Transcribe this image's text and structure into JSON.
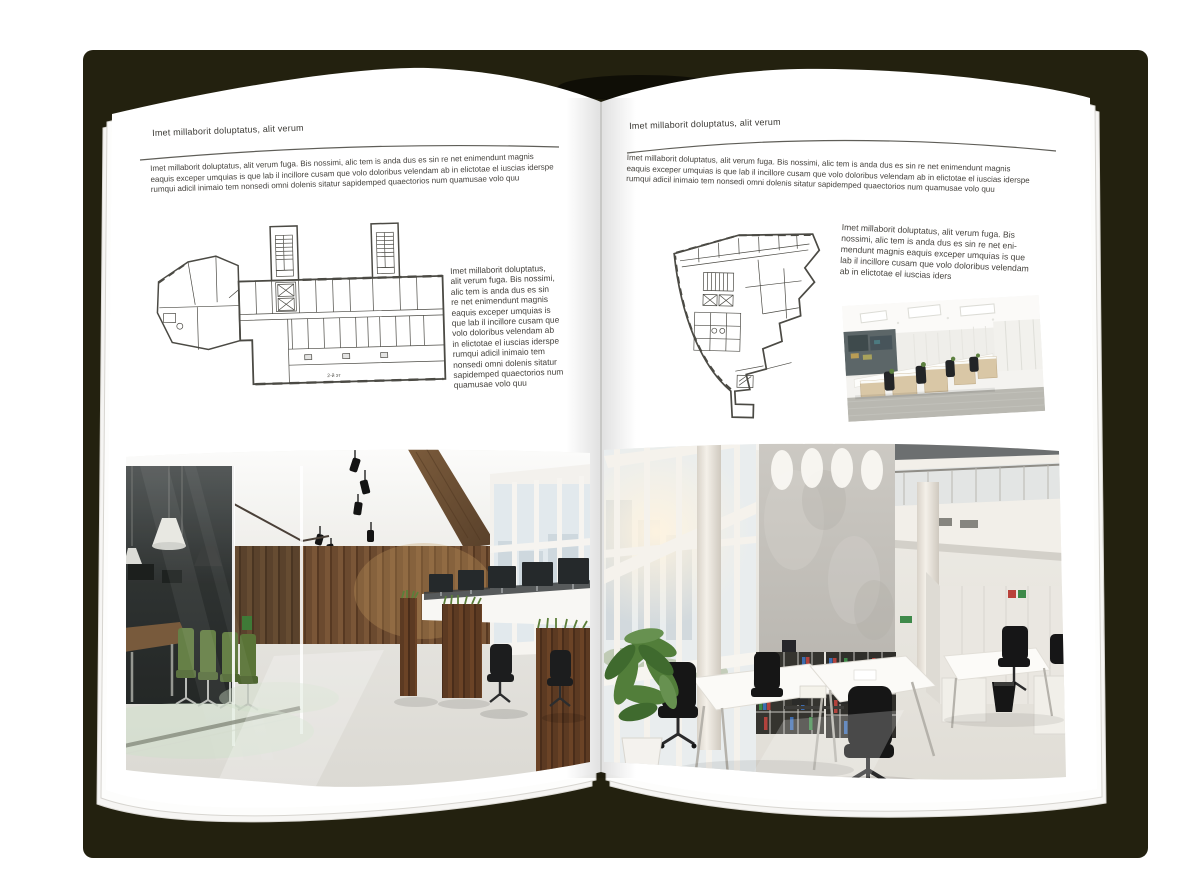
{
  "spread": {
    "left_page": {
      "header": "Imet millaborit doluptatus, alit verum",
      "intro_lines": [
        "Imet millaborit doluptatus, alit verum fuga. Bis nossimi, alic tem is anda dus es sin re net enimendunt magnis",
        "eaquis exceper umquias is que lab il incillore cusam que volo doloribus velendam ab in elictotae el iuscias iderspe",
        "rumqui adicil inimaio tem nonsedi omni dolenis sitatur sapidemped quaectorios num quamusae volo quu"
      ],
      "caption_lines": [
        "Imet millaborit doluptatus,",
        "alit verum fuga. Bis nossimi,",
        "alic tem is anda dus es sin",
        "re net enimendunt magnis",
        "eaquis exceper umquias is",
        "que lab il incillore cusam que",
        "volo doloribus velendam ab",
        "in elictotae el iuscias iderspe",
        "rumqui adicil inimaio tem",
        "nonsedi omni dolenis sitatur",
        "sapidemped quaectorios num",
        "quamusae volo quu"
      ],
      "plan_label": "2-й эт"
    },
    "right_page": {
      "header": "Imet millaborit doluptatus, alit verum",
      "intro_lines": [
        "Imet millaborit doluptatus, alit verum fuga. Bis nossimi, alic tem is anda dus es sin re net enimendunt magnis",
        "eaquis exceper umquias is que lab il incillore cusam que volo doloribus velendam ab in elictotae el iuscias iderspe",
        "rumqui adicil inimaio tem nonsedi omni dolenis sitatur sapidemped quaectorios num quamusae volo quu"
      ],
      "caption_lines": [
        "Imet millaborit doluptatus, alit verum fuga. Bis",
        "nossimi, alic tem is anda dus es sin re net eni-",
        "mendunt magnis eaquis exceper umquias is que",
        "lab il incillore cusam que volo doloribus velendam",
        "ab in elictotae el iuscias iders"
      ]
    }
  },
  "colors": {
    "cover": "#23210f",
    "page": "#ffffff",
    "text": "#45423d",
    "plan_line": "#4b4a44",
    "wood": "#7a5637",
    "chair_green": "#5a7437",
    "binder_red": "#b2423c",
    "binder_blue": "#3d6cb0",
    "binder_green": "#3e8a49"
  }
}
